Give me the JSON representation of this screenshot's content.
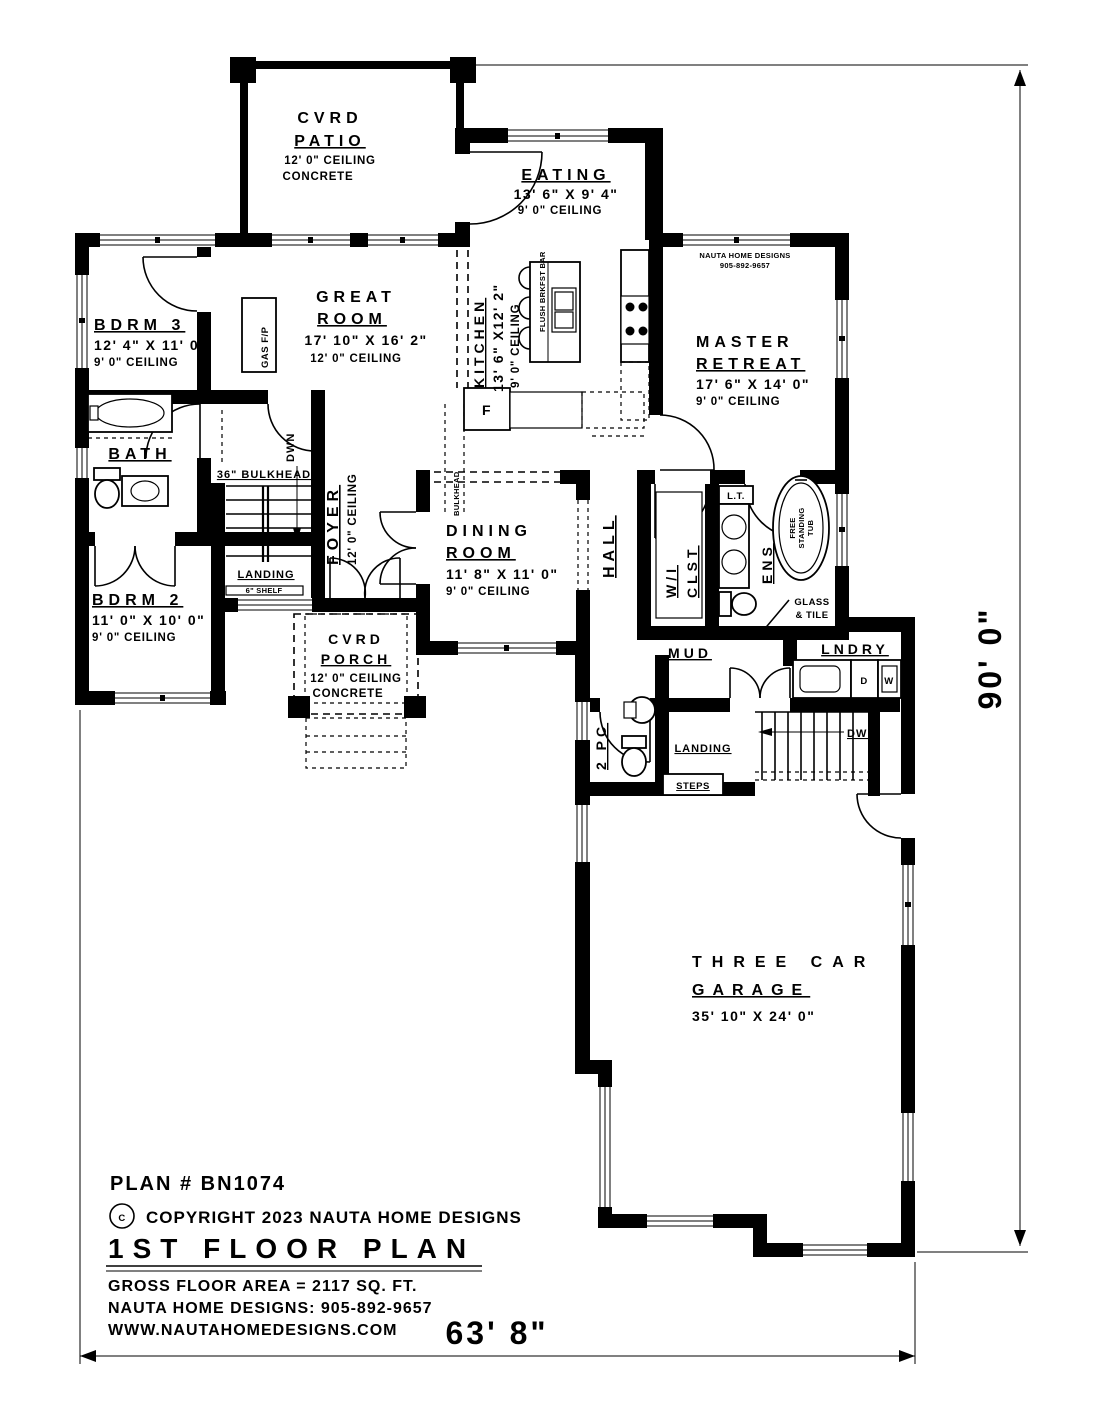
{
  "page": {
    "background": "#ffffff",
    "ink": "#000000"
  },
  "title_block": {
    "plan_number": "PLAN # BN1074",
    "copyright_symbol": "C",
    "copyright_text": "COPYRIGHT 2023 NAUTA HOME DESIGNS",
    "floor_title": "1ST FLOOR PLAN",
    "gross_area": "GROSS FLOOR AREA  =  2117  SQ. FT.",
    "designer_phone": "NAUTA HOME DESIGNS:  905-892-9657",
    "website": "WWW.NAUTAHOMEDESIGNS.COM"
  },
  "dimensions": {
    "overall_width": "63' 8\"",
    "overall_depth": "90' 0\""
  },
  "watermark": {
    "line1": "NAUTA HOME DESIGNS",
    "line2": "905-892-9657"
  },
  "rooms": {
    "cvrd_patio": {
      "line1": "CVRD",
      "line2": "PATIO",
      "ceiling": "12' 0\" CEILING",
      "note": "CONCRETE"
    },
    "eating": {
      "name": "EATING",
      "dims": "13' 6\" X 9' 4\"",
      "ceiling": "9' 0\" CEILING"
    },
    "bdrm3": {
      "name": "BDRM 3",
      "dims": "12' 4\" X 11' 0\"",
      "ceiling": "9' 0\" CEILING"
    },
    "great_room": {
      "line1": "GREAT",
      "line2": "ROOM",
      "dims": "17' 10\" X 16' 2\"",
      "ceiling": "12' 0\" CEILING"
    },
    "kitchen": {
      "name": "KITCHEN",
      "dims": "13' 6\" X12' 2\"",
      "ceiling": "9' 0\" CEILING"
    },
    "master_retreat": {
      "line1": "MASTER",
      "line2": "RETREAT",
      "dims": "17' 6\" X 14' 0\"",
      "ceiling": "9' 0\" CEILING"
    },
    "bath": {
      "name": "BATH"
    },
    "foyer": {
      "name": "FOYER",
      "ceiling": "12' 0\" CEILING"
    },
    "bdrm2": {
      "name": "BDRM 2",
      "dims": "11' 0\" X 10' 0\"",
      "ceiling": "9' 0\" CEILING"
    },
    "dining_room": {
      "line1": "DINING",
      "line2": "ROOM",
      "dims": "11' 8\" X 11' 0\"",
      "ceiling": "9' 0\" CEILING"
    },
    "hall": {
      "name": "HALL"
    },
    "wi_clst": {
      "line1": "W/I",
      "line2": "CLST"
    },
    "ens": {
      "name": "ENS"
    },
    "cvrd_porch": {
      "line1": "CVRD",
      "line2": "PORCH",
      "ceiling": "12' 0\" CEILING",
      "note": "CONCRETE"
    },
    "mud": {
      "name": "MUD"
    },
    "lndry": {
      "name": "LNDRY"
    },
    "two_pc": {
      "name": "2 PC"
    },
    "garage": {
      "line1": "THREE CAR",
      "line2": "GARAGE",
      "dims": "35' 10\" X 24' 0\""
    }
  },
  "annotations": {
    "gas_fp": "GAS F/P",
    "dwn_foyer": "DWN",
    "bulkhead_36": "36\" BULKHEAD",
    "bulkhead": "BULKHEAD",
    "landing_foyer": "LANDING",
    "shelf": "6\" SHELF",
    "flush_brkfst_bar": "FLUSH BRKFST BAR",
    "fridge": "F",
    "linen_tower": "L.T.",
    "tub_line1": "FREE",
    "tub_line2": "STANDING",
    "tub_line3": "TUB",
    "glass_line1": "GLASS",
    "glass_line2": "& TILE",
    "landing_mud": "LANDING",
    "steps": "STEPS",
    "dwn_basement": "DWN",
    "dryer": "D",
    "washer": "W"
  }
}
